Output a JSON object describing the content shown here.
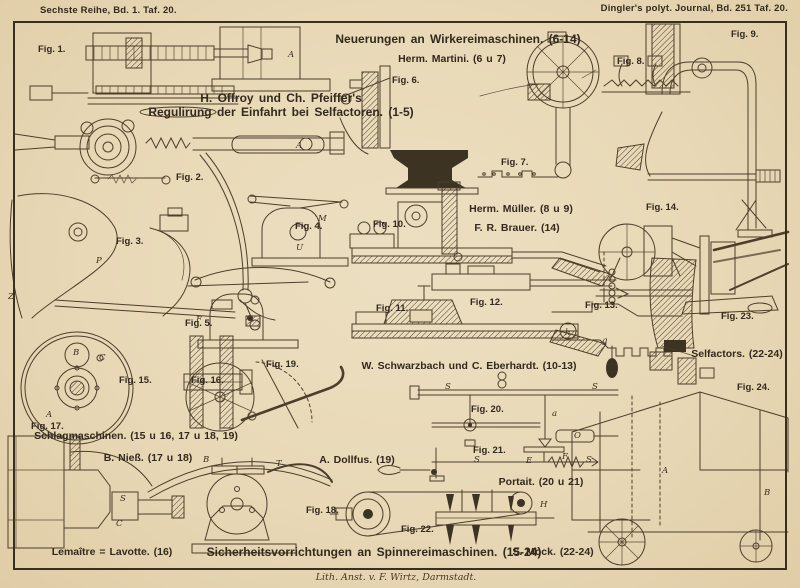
{
  "page": {
    "top_left": "Sechste Reihe, Bd. 1. Taf. 20.",
    "top_right": "Dingler's polyt. Journal, Bd. 251 Taf. 20.",
    "imprint": "Lith. Anst. v. F. Wirtz, Darmstadt."
  },
  "headings": {
    "wirkerei": "Neuerungen an Wirkereimaschinen. (6-14)",
    "martini": "Herm. Martini. (6 u 7)",
    "offroy_line1": "H. Offroy und Ch. Pfeiffer's",
    "offroy_line2": "Regulirung der Einfahrt bei Selfactoren. (1-5)",
    "mueller": "Herm. Müller. (8 u 9)",
    "brauer": "F. R. Brauer. (14)",
    "schwarzbach": "W. Schwarzbach und C. Eberhardt. (10-13)",
    "schlagmaschinen": "Schlagmaschinen. (15 u 16, 17 u 18, 19)",
    "niess": "B. Nieß. (17 u 18)",
    "dollfus": "A. Dollfus. (19)",
    "portait": "Portait. (20 u 21)",
    "lemaitre": "Lemaître = Lavotte. (16)",
    "sicherheits": "Sicherheitsvorrichtungen an Spinnereimaschinen. (15-24)",
    "mock": "S. Mock. (22-24)",
    "selfactors": "Selfactors. (22-24)"
  },
  "figures": [
    {
      "label": "Fig. 1.",
      "x": 38,
      "y": 44
    },
    {
      "label": "Fig. 2.",
      "x": 176,
      "y": 172
    },
    {
      "label": "Fig. 3.",
      "x": 116,
      "y": 236
    },
    {
      "label": "Fig. 4.",
      "x": 295,
      "y": 221
    },
    {
      "label": "Fig. 5.",
      "x": 185,
      "y": 318
    },
    {
      "label": "Fig. 6.",
      "x": 392,
      "y": 75
    },
    {
      "label": "Fig. 7.",
      "x": 501,
      "y": 157
    },
    {
      "label": "Fig. 8.",
      "x": 617,
      "y": 56
    },
    {
      "label": "Fig. 9.",
      "x": 731,
      "y": 29
    },
    {
      "label": "Fig. 10.",
      "x": 373,
      "y": 219
    },
    {
      "label": "Fig. 11.",
      "x": 376,
      "y": 303
    },
    {
      "label": "Fig. 12.",
      "x": 470,
      "y": 297
    },
    {
      "label": "Fig. 13.",
      "x": 585,
      "y": 300
    },
    {
      "label": "Fig. 14.",
      "x": 646,
      "y": 202
    },
    {
      "label": "Fig. 15.",
      "x": 119,
      "y": 375
    },
    {
      "label": "Fig. 16.",
      "x": 191,
      "y": 375
    },
    {
      "label": "Fig. 17.",
      "x": 31,
      "y": 421
    },
    {
      "label": "Fig. 18.",
      "x": 306,
      "y": 505
    },
    {
      "label": "Fig. 19.",
      "x": 266,
      "y": 359
    },
    {
      "label": "Fig. 20.",
      "x": 471,
      "y": 404
    },
    {
      "label": "Fig. 21.",
      "x": 473,
      "y": 445
    },
    {
      "label": "Fig. 22.",
      "x": 401,
      "y": 524
    },
    {
      "label": "Fig. 23.",
      "x": 721,
      "y": 311
    },
    {
      "label": "Fig. 24.",
      "x": 737,
      "y": 382
    }
  ],
  "part_letters": [
    {
      "t": "A",
      "x": 288,
      "y": 50
    },
    {
      "t": "A",
      "x": 296,
      "y": 141
    },
    {
      "t": "F",
      "x": 196,
      "y": 315
    },
    {
      "t": "Z",
      "x": 8,
      "y": 292
    },
    {
      "t": "P",
      "x": 96,
      "y": 256
    },
    {
      "t": "M",
      "x": 318,
      "y": 214
    },
    {
      "t": "U",
      "x": 296,
      "y": 243
    },
    {
      "t": "B",
      "x": 73,
      "y": 348
    },
    {
      "t": "C",
      "x": 99,
      "y": 353
    },
    {
      "t": "A",
      "x": 46,
      "y": 410
    },
    {
      "t": "S",
      "x": 120,
      "y": 494
    },
    {
      "t": "C",
      "x": 116,
      "y": 519
    },
    {
      "t": "T",
      "x": 276,
      "y": 459
    },
    {
      "t": "B",
      "x": 203,
      "y": 455
    },
    {
      "t": "h",
      "x": 565,
      "y": 328
    },
    {
      "t": "g",
      "x": 602,
      "y": 336
    },
    {
      "t": "a",
      "x": 552,
      "y": 409
    },
    {
      "t": "O",
      "x": 574,
      "y": 431
    },
    {
      "t": "E",
      "x": 526,
      "y": 456
    },
    {
      "t": "F",
      "x": 562,
      "y": 452
    },
    {
      "t": "S",
      "x": 445,
      "y": 382
    },
    {
      "t": "S",
      "x": 592,
      "y": 382
    },
    {
      "t": "S",
      "x": 474,
      "y": 455
    },
    {
      "t": "S",
      "x": 586,
      "y": 455
    },
    {
      "t": "H",
      "x": 540,
      "y": 500
    },
    {
      "t": "A",
      "x": 662,
      "y": 466
    },
    {
      "t": "B",
      "x": 764,
      "y": 488
    }
  ]
}
